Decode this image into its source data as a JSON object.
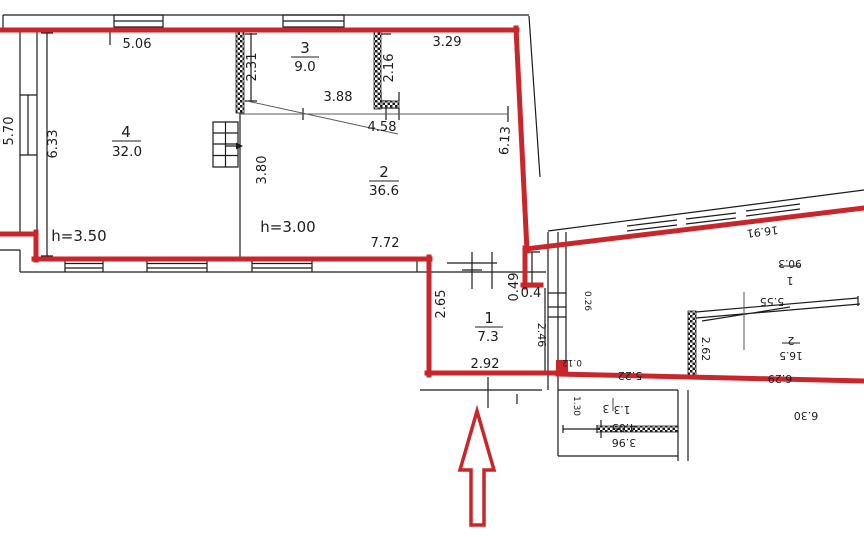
{
  "colors": {
    "red": "#c9262c",
    "line": "#1c1c1c"
  },
  "main_plan": {
    "rooms": {
      "r4": {
        "number": "4",
        "area": "32.0"
      },
      "r3": {
        "number": "3",
        "area": "9.0"
      },
      "r2": {
        "number": "2",
        "area": "36.6"
      },
      "r1": {
        "number": "1",
        "area": "7.3"
      }
    },
    "heights": {
      "left": "h=3.50",
      "right": "h=3.00"
    },
    "dims": {
      "top": "5.06",
      "top_right": "3.29",
      "left_outer": "5.70",
      "left_inner": "6.33",
      "partition_left": "2.31",
      "partition_right": "2.16",
      "niche_width": "0.50",
      "niche_depth": "0.15",
      "mid_upper": "3.88",
      "mid_lower": "4.58",
      "stair_wall": "3.80",
      "right_wall": "6.13",
      "room2_width": "7.72",
      "room1_depth": "2.65",
      "room1_width": "2.92",
      "entry_a": "0.49",
      "entry_b": "0.4"
    }
  },
  "adjacent_plan": {
    "rooms": {
      "hall": {
        "number": "1",
        "area": "90.3"
      },
      "inner": {
        "number": "2",
        "area": "16.5"
      },
      "small": {
        "number": "3",
        "area": "1.3"
      }
    },
    "dims": {
      "slant_top": "16.91",
      "hall_width": "5.55",
      "inner_left": "2.62",
      "inner_bottom": "6.29",
      "bottom_left": "5.22",
      "notch": "0.12",
      "wall_window": "0.26",
      "left_wall": "2.46",
      "small_top": "4.05",
      "small_bottom": "3.96",
      "small_left": "1.30",
      "hall_bottom": "6.30"
    }
  }
}
